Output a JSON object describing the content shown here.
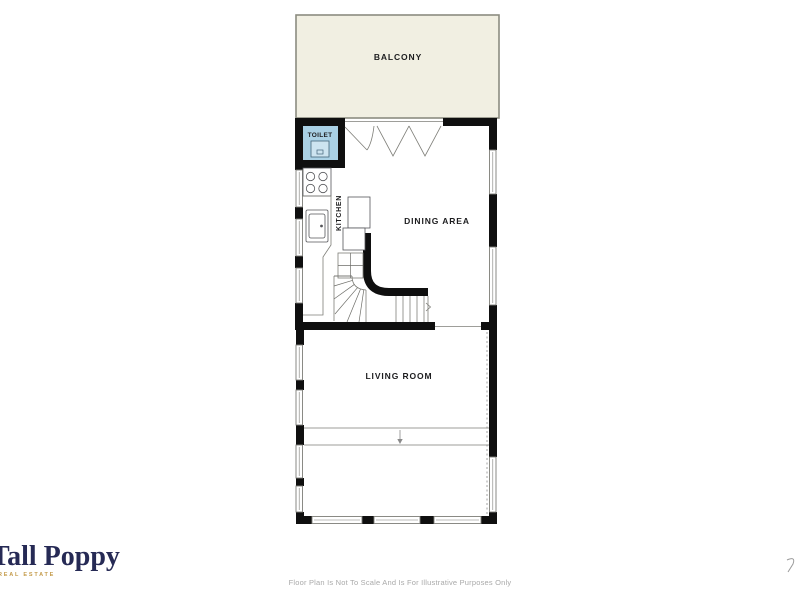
{
  "floor_plan": {
    "rooms": {
      "balcony": {
        "label": "BALCONY"
      },
      "toilet": {
        "label": "TOILET"
      },
      "kitchen": {
        "label": "KITCHEN"
      },
      "dining": {
        "label": "DINING AREA"
      },
      "living": {
        "label": "LIVING ROOM"
      }
    },
    "colors": {
      "wall": "#0f0f0f",
      "line": "#7e7e78",
      "label": "#1d1d1f",
      "balcony_fill": "#f1efe2",
      "balcony_stroke": "#8c8c80",
      "toilet_fill": "#aad1e5",
      "brand": "#262a55",
      "gold": "#c49b4b",
      "muted": "#a9a9a9"
    }
  },
  "branding": {
    "name": "Tall Poppy",
    "tagline": "REAL ESTATE"
  },
  "footer": {
    "disclaimer": "Floor Plan Is Not To Scale And Is For Illustrative Purposes Only"
  }
}
